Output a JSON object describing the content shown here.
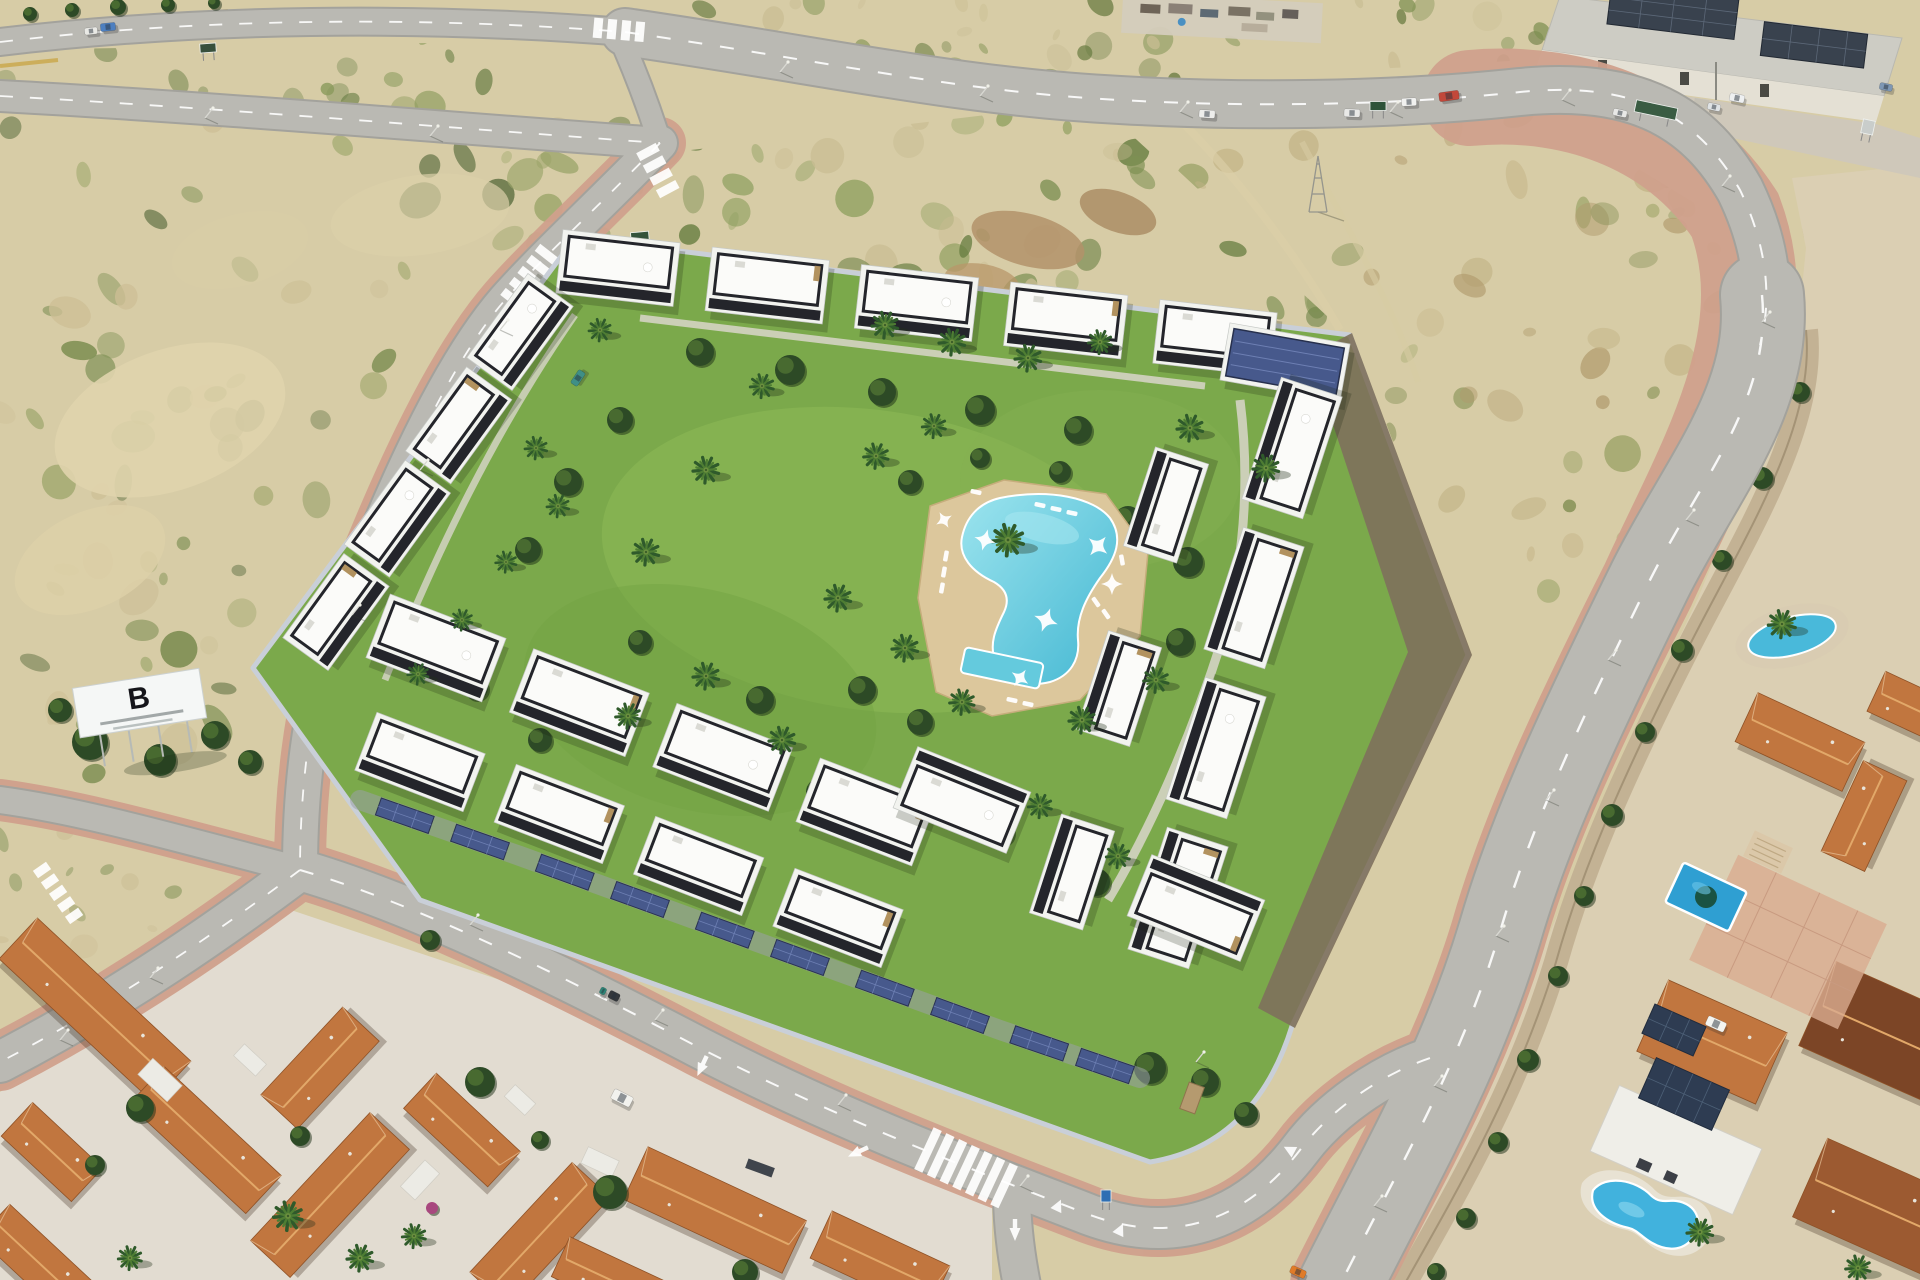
{
  "meta": {
    "description": "Aerial render of a modern white residential complex with black roof parapets around a central garden with palm trees and a free-form pool, bordered by new roads, vacant scrubland, an industrial warehouse and older terracotta-roof villas"
  },
  "billboard": {
    "logo": "B"
  },
  "palette": {
    "sand": "#d7cca6",
    "sandLight": "#e4dbba",
    "road": "#bab9b3",
    "roadEdge": "#a3a29c",
    "sidewalk": "#d0a08c",
    "lawn": "#7ba94b",
    "lawnLight": "#8fbb58",
    "shrub": "#2d4a26",
    "shrubLight": "#4e7032",
    "pool": "#4ab7d3",
    "poolLight": "#9ce4ee",
    "deck": "#dcc79c",
    "deckEdge": "#c6ad7c",
    "building": "#f2f3ef",
    "parapet": "#24252b",
    "stone": "#b2925f",
    "solar": "#47598c",
    "solarLine": "#6d7fb3",
    "terracotta": "#c1763f",
    "terracottaRidge": "#e2a869",
    "wall": "#c9cfd8",
    "dirt": "#7e705c",
    "warehouseRoof": "#cdccc4",
    "warehouseWall": "#e4e0d4",
    "mustard": "#c9a648",
    "white": "#ffffff"
  },
  "objects": {
    "scrub_regions": [
      {
        "clip": "clipZ1",
        "x": 0,
        "y": 40,
        "w": 660,
        "h": 100,
        "n": 26,
        "seed": 11,
        "rmin": 5,
        "rmax": 16,
        "colors": [
          "#8a9a5b",
          "#6d8148",
          "#c9bd93"
        ]
      },
      {
        "clip": "clipZ2",
        "x": 0,
        "y": 105,
        "w": 650,
        "h": 700,
        "n": 115,
        "seed": 22,
        "rmin": 6,
        "rmax": 22,
        "colors": [
          "#84945a",
          "#69803f",
          "#55693a",
          "#cdbf96",
          "#9aa468"
        ]
      },
      {
        "clip": "clipZ3",
        "x": 540,
        "y": 95,
        "w": 810,
        "h": 245,
        "n": 90,
        "seed": 33,
        "rmin": 6,
        "rmax": 20,
        "colors": [
          "#7d9053",
          "#647b3e",
          "#8fa060",
          "#c9bd93"
        ]
      },
      {
        "clip": "clipZ4",
        "x": 1090,
        "y": 90,
        "w": 690,
        "h": 570,
        "n": 100,
        "seed": 44,
        "rmin": 6,
        "rmax": 20,
        "colors": [
          "#9aa265",
          "#7f8c50",
          "#c3b386",
          "#b09a6c"
        ]
      },
      {
        "clip": "clipZ5",
        "x": 640,
        "y": 0,
        "w": 920,
        "h": 92,
        "n": 48,
        "seed": 55,
        "rmin": 5,
        "rmax": 16,
        "colors": [
          "#7f9152",
          "#66793f",
          "#c9bd93"
        ]
      },
      {
        "clip": "clipZ6",
        "x": 0,
        "y": 810,
        "w": 280,
        "h": 235,
        "n": 22,
        "seed": 66,
        "rmin": 5,
        "rmax": 14,
        "colors": [
          "#84945a",
          "#cdbf96"
        ]
      },
      {
        "clip": "clipVilla",
        "x": 1400,
        "y": 170,
        "w": 520,
        "h": 1115,
        "n": 42,
        "seed": 77,
        "rmin": 5,
        "rmax": 13,
        "colors": [
          "#9f9d74",
          "#b7a77f",
          "#8c9159"
        ]
      }
    ],
    "building_rows": [
      {
        "x1": 618,
        "y1": 268,
        "x2": 1215,
        "y2": 338,
        "n": 5,
        "w": 118,
        "h": 64,
        "a": 6.5,
        "parasol": true,
        "flip": false
      },
      {
        "x1": 1285,
        "y1": 362,
        "x2": 1285,
        "y2": 362,
        "n": 1,
        "w": 122,
        "h": 58,
        "a": 10,
        "style": "solar"
      },
      {
        "x1": 1292,
        "y1": 448,
        "x2": 1178,
        "y2": 898,
        "n": 4,
        "w": 128,
        "h": 64,
        "a": -72,
        "parasol": true,
        "flip": true
      },
      {
        "x1": 1166,
        "y1": 505,
        "x2": 1072,
        "y2": 872,
        "n": 3,
        "w": 104,
        "h": 56,
        "a": -72,
        "flip": true
      },
      {
        "x1": 520,
        "y1": 332,
        "x2": 336,
        "y2": 612,
        "n": 4,
        "w": 104,
        "h": 56,
        "a": -54,
        "parasol": true,
        "flip": false
      },
      {
        "x1": 436,
        "y1": 648,
        "x2": 866,
        "y2": 812,
        "n": 4,
        "w": 124,
        "h": 68,
        "a": 21,
        "parasol": true,
        "flip": false
      },
      {
        "x1": 420,
        "y1": 762,
        "x2": 838,
        "y2": 918,
        "n": 4,
        "w": 116,
        "h": 62,
        "a": 21,
        "flip": false
      },
      {
        "x1": 962,
        "y1": 800,
        "x2": 1196,
        "y2": 908,
        "n": 2,
        "w": 122,
        "h": 66,
        "a": 22,
        "parasol": true,
        "flip": true
      }
    ],
    "solar_carport": {
      "points": [
        [
          360,
          800
        ],
        [
          520,
          856
        ],
        [
          680,
          914
        ],
        [
          840,
          972
        ],
        [
          1000,
          1030
        ],
        [
          1140,
          1078
        ]
      ]
    },
    "palms": [
      [
        885,
        325,
        1
      ],
      [
        952,
        342,
        1
      ],
      [
        1028,
        358,
        1
      ],
      [
        762,
        386,
        0.9
      ],
      [
        706,
        470,
        1
      ],
      [
        646,
        552,
        1
      ],
      [
        876,
        456,
        0.95
      ],
      [
        934,
        426,
        0.9
      ],
      [
        1190,
        428,
        1
      ],
      [
        1266,
        468,
        1
      ],
      [
        1008,
        540,
        1.2
      ],
      [
        838,
        598,
        1
      ],
      [
        905,
        648,
        1
      ],
      [
        962,
        702,
        0.95
      ],
      [
        706,
        676,
        1
      ],
      [
        628,
        716,
        0.95
      ],
      [
        782,
        740,
        1
      ],
      [
        1082,
        720,
        1
      ],
      [
        1156,
        680,
        0.95
      ],
      [
        1100,
        342,
        0.9
      ],
      [
        1040,
        806,
        0.9
      ],
      [
        1118,
        856,
        0.9
      ],
      [
        600,
        330,
        0.85
      ],
      [
        536,
        448,
        0.85
      ],
      [
        558,
        506,
        0.85
      ],
      [
        506,
        562,
        0.8
      ],
      [
        462,
        620,
        0.8
      ],
      [
        418,
        674,
        0.8
      ],
      [
        288,
        1216,
        1.1
      ],
      [
        360,
        1258,
        1
      ],
      [
        414,
        1236,
        0.9
      ],
      [
        130,
        1258,
        0.9
      ],
      [
        1782,
        624,
        1.05
      ],
      [
        1700,
        1232,
        1
      ],
      [
        1858,
        1268,
        0.95
      ]
    ],
    "shrubs": [
      [
        700,
        352,
        14
      ],
      [
        790,
        370,
        15
      ],
      [
        882,
        392,
        14
      ],
      [
        980,
        410,
        15
      ],
      [
        1078,
        430,
        14
      ],
      [
        620,
        420,
        13
      ],
      [
        568,
        482,
        14
      ],
      [
        528,
        550,
        13
      ],
      [
        910,
        482,
        12
      ],
      [
        1128,
        520,
        14
      ],
      [
        1188,
        562,
        15
      ],
      [
        862,
        690,
        14
      ],
      [
        920,
        722,
        13
      ],
      [
        760,
        700,
        14
      ],
      [
        680,
        762,
        13
      ],
      [
        820,
        792,
        14
      ],
      [
        1120,
        702,
        15
      ],
      [
        1180,
        642,
        14
      ],
      [
        640,
        642,
        12
      ],
      [
        584,
        692,
        12
      ],
      [
        1000,
        832,
        14
      ],
      [
        1096,
        882,
        14
      ],
      [
        476,
        688,
        12
      ],
      [
        540,
        740,
        12
      ],
      [
        430,
        940,
        10
      ],
      [
        980,
        458,
        10
      ],
      [
        1060,
        472,
        11
      ],
      [
        1150,
        1068,
        16
      ],
      [
        1205,
        1082,
        14
      ],
      [
        1246,
        1114,
        12
      ],
      [
        90,
        742,
        18
      ],
      [
        160,
        760,
        16
      ],
      [
        215,
        735,
        14
      ],
      [
        120,
        700,
        12
      ],
      [
        250,
        762,
        12
      ],
      [
        60,
        710,
        12
      ],
      [
        30,
        14,
        7
      ],
      [
        72,
        10,
        7
      ],
      [
        118,
        7,
        8
      ],
      [
        168,
        5,
        7
      ],
      [
        214,
        3,
        6
      ]
    ],
    "villa_shrubs": [
      [
        1800,
        392,
        10
      ],
      [
        1762,
        478,
        11
      ],
      [
        1722,
        560,
        10
      ],
      [
        1682,
        650,
        11
      ],
      [
        1645,
        732,
        10
      ],
      [
        1612,
        815,
        11
      ],
      [
        1584,
        896,
        10
      ],
      [
        1558,
        976,
        10
      ],
      [
        1528,
        1060,
        11
      ],
      [
        1498,
        1142,
        10
      ],
      [
        1466,
        1218,
        10
      ],
      [
        1436,
        1272,
        9
      ]
    ],
    "town_trees": [
      [
        140,
        1108,
        14
      ],
      [
        300,
        1136,
        10
      ],
      [
        480,
        1082,
        15
      ],
      [
        610,
        1192,
        17
      ],
      [
        745,
        1272,
        13
      ],
      [
        95,
        1165,
        10
      ],
      [
        540,
        1140,
        9
      ],
      [
        432,
        1208,
        6,
        "#a8487e"
      ]
    ],
    "orange_houses": [
      [
        95,
        1010,
        210,
        56,
        43
      ],
      [
        205,
        1140,
        160,
        52,
        43
      ],
      [
        52,
        1152,
        96,
        46,
        43
      ],
      [
        320,
        1068,
        120,
        50,
        -47
      ],
      [
        330,
        1195,
        175,
        54,
        -47
      ],
      [
        462,
        1130,
        115,
        48,
        43
      ],
      [
        540,
        1235,
        150,
        52,
        -47
      ],
      [
        715,
        1210,
        175,
        58,
        25
      ],
      [
        880,
        1262,
        130,
        52,
        25
      ],
      [
        38,
        1262,
        120,
        46,
        43
      ],
      [
        615,
        1282,
        120,
        44,
        25
      ],
      [
        1800,
        742,
        118,
        54,
        25
      ],
      [
        1864,
        816,
        100,
        48,
        -65
      ],
      [
        1908,
        706,
        70,
        44,
        25
      ],
      [
        1712,
        1042,
        130,
        78,
        24
      ],
      [
        1886,
        1034,
        150,
        92,
        24,
        "#7c4526"
      ],
      [
        1874,
        1206,
        140,
        86,
        24,
        "#9c5a31"
      ]
    ],
    "town_white": [
      [
        160,
        1080,
        40,
        22,
        43
      ],
      [
        420,
        1180,
        36,
        20,
        -47
      ],
      [
        600,
        1162,
        34,
        18,
        25
      ],
      [
        250,
        1060,
        30,
        16,
        43
      ],
      [
        520,
        1100,
        28,
        16,
        43
      ]
    ],
    "cars": [
      [
        108,
        27,
        15,
        8,
        -6,
        "#4d7fc0"
      ],
      [
        91,
        31,
        13,
        7,
        -6,
        "#e9e9e5"
      ],
      [
        1207,
        114,
        16,
        8,
        4,
        "#ededeb"
      ],
      [
        1352,
        113,
        16,
        8,
        2,
        "#e9e9e7"
      ],
      [
        1409,
        102,
        15,
        8,
        -3,
        "#f1f1ef"
      ],
      [
        1449,
        96,
        20,
        9,
        -8,
        "#c2483a"
      ],
      [
        1737,
        98,
        15,
        8,
        12,
        "#eef0f1"
      ],
      [
        1714,
        107,
        13,
        7,
        12,
        "#dfe3e5"
      ],
      [
        1620,
        113,
        14,
        7,
        12,
        "#e8e8e6"
      ],
      [
        1886,
        87,
        13,
        7,
        12,
        "#7e97b4"
      ],
      [
        578,
        378,
        16,
        8,
        -56,
        "#3f8f86"
      ],
      [
        622,
        1098,
        21,
        11,
        27,
        "#f2f2ee"
      ],
      [
        1716,
        1024,
        20,
        10,
        24,
        "#f4f4f0"
      ],
      [
        614,
        996,
        11,
        8,
        27,
        "#34383c"
      ],
      [
        603,
        991,
        6,
        7,
        27,
        "#2f8577"
      ],
      [
        1298,
        1272,
        16,
        8,
        24,
        "#e07b28"
      ]
    ],
    "light_poles": [
      [
        780,
        72
      ],
      [
        980,
        96
      ],
      [
        1180,
        112
      ],
      [
        1390,
        112
      ],
      [
        1562,
        100
      ],
      [
        1722,
        186
      ],
      [
        1762,
        322
      ],
      [
        1686,
        520
      ],
      [
        1608,
        660
      ],
      [
        1546,
        800
      ],
      [
        1496,
        936
      ],
      [
        1434,
        1086
      ],
      [
        1374,
        1206
      ],
      [
        500,
        330
      ],
      [
        420,
        470
      ],
      [
        352,
        615
      ],
      [
        470,
        925
      ],
      [
        655,
        1020
      ],
      [
        838,
        1105
      ],
      [
        1020,
        1186
      ],
      [
        205,
        118
      ],
      [
        430,
        136
      ],
      [
        150,
        978
      ],
      [
        60,
        1040
      ],
      [
        1196,
        1062
      ]
    ],
    "loungers": [
      [
        1040,
        505,
        12
      ],
      [
        1056,
        509,
        12
      ],
      [
        1072,
        513,
        12
      ],
      [
        946,
        556,
        100
      ],
      [
        944,
        572,
        100
      ],
      [
        942,
        588,
        100
      ],
      [
        1096,
        602,
        55
      ],
      [
        1106,
        614,
        55
      ],
      [
        1012,
        700,
        12
      ],
      [
        1028,
        704,
        12
      ],
      [
        1122,
        560,
        80
      ],
      [
        976,
        492,
        12
      ]
    ],
    "sails": [
      [
        985,
        540,
        1.1,
        15
      ],
      [
        1098,
        546,
        1.2,
        40
      ],
      [
        1112,
        584,
        1.1,
        0
      ],
      [
        1046,
        620,
        1.25,
        20
      ],
      [
        1020,
        678,
        1,
        35
      ],
      [
        944,
        520,
        0.9,
        60
      ]
    ],
    "zebras": [
      {
        "x": 598,
        "y": 28,
        "a": 5,
        "n": 4,
        "len": 20
      },
      {
        "x": 514,
        "y": 300,
        "a": -52,
        "n": 5,
        "len": 28
      },
      {
        "x": 928,
        "y": 1150,
        "a": 25,
        "n": 7,
        "len": 46
      },
      {
        "x": 42,
        "y": 870,
        "a": 55,
        "n": 5,
        "len": 16
      },
      {
        "x": 648,
        "y": 152,
        "a": 62,
        "n": 4,
        "len": 22
      }
    ],
    "arrows": [
      [
        858,
        1152,
        245
      ],
      [
        702,
        1066,
        205
      ],
      [
        1015,
        1230,
        180
      ]
    ],
    "triangles": [
      [
        1058,
        1206,
        25
      ],
      [
        1290,
        1150,
        -62
      ],
      [
        1120,
        1230,
        25
      ]
    ],
    "signs": [
      [
        640,
        238,
        18,
        12,
        "#33523b",
        -5
      ],
      [
        208,
        48,
        16,
        9,
        "#37503c",
        -4
      ],
      [
        1378,
        106,
        16,
        9,
        "#2e5339",
        0
      ],
      [
        1656,
        110,
        42,
        12,
        "#3a5c43",
        12
      ],
      [
        1868,
        127,
        12,
        14,
        "#c9cdcb",
        12
      ],
      [
        1106,
        1196,
        10,
        12,
        "#2f6fb3",
        0
      ]
    ]
  }
}
